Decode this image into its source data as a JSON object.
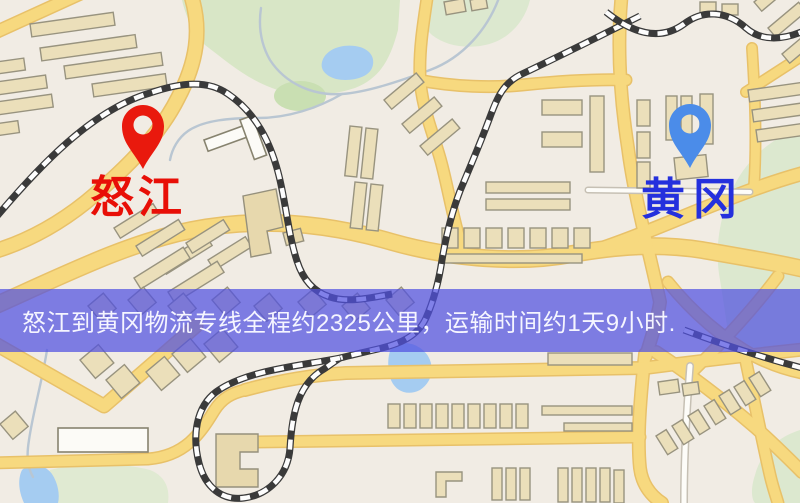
{
  "map": {
    "origin": {
      "label": "怒江",
      "pin_color": "#e9190d",
      "label_color": "#e80f07"
    },
    "destination": {
      "label": "黄冈",
      "pin_color": "#4b8ce9",
      "label_color": "#2430dd"
    }
  },
  "banner": {
    "text": "怒江到黄冈物流专线全程约2325公里，运输时间约1天9小时.",
    "background_color": "rgba(80,81,224,0.72)",
    "text_color": "#f5f5ff"
  },
  "palette": {
    "map_background": "#f1ece4",
    "road_yellow": "#f7d97f",
    "road_casing": "#e8c169",
    "building_fill": "#ebdfba",
    "building_stroke": "#98937f",
    "park_green": "#d8e6c6",
    "water_blue": "#a5ccf1",
    "railway_dark": "#3a3a3a"
  }
}
